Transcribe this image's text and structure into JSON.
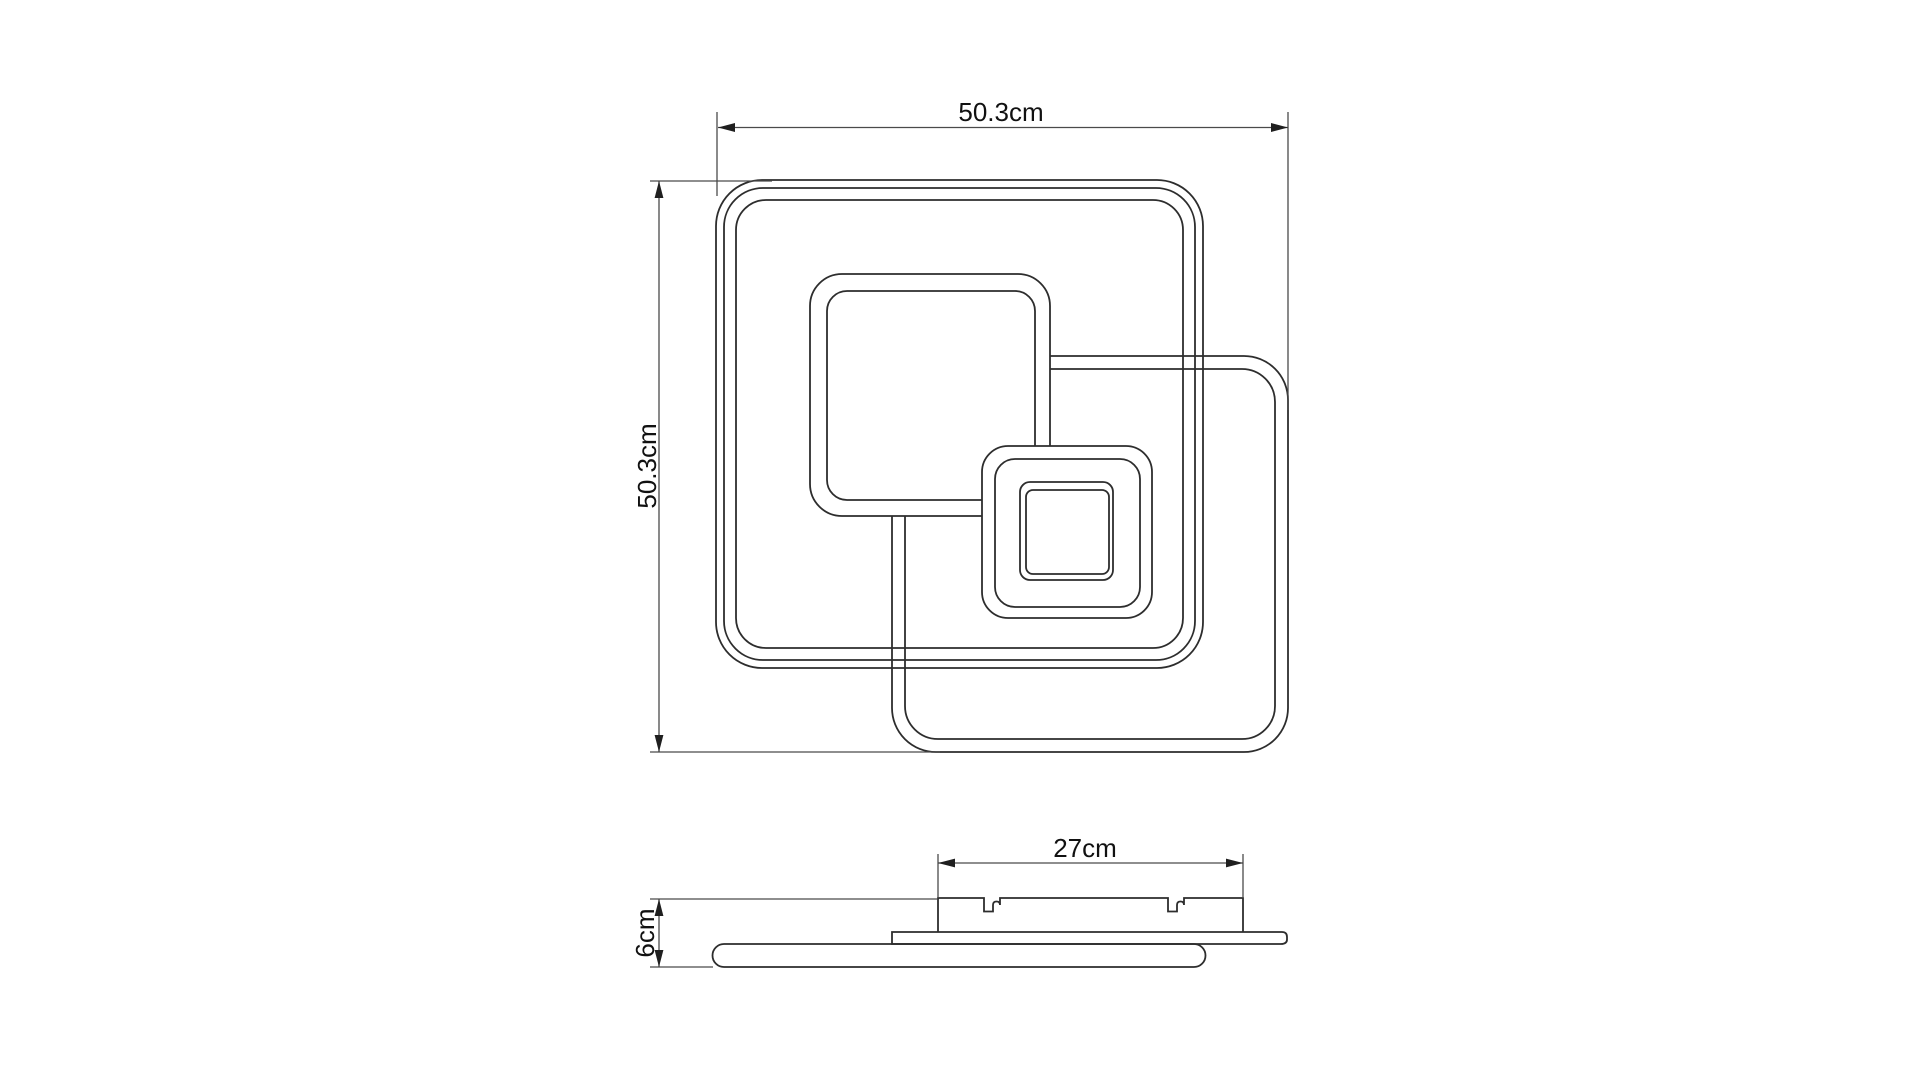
{
  "drawing": {
    "kind": "ceiling-lamp dimensional line drawing",
    "views": {
      "top_view": {
        "width_label": "50.3cm",
        "height_label": "50.3cm"
      },
      "side_view": {
        "width_label": "27cm",
        "height_label": "6cm"
      }
    },
    "colors": {
      "background": "#ffffff",
      "shape_line": "#2d2d2d",
      "dimension_line": "#4a4a4a",
      "text": "#111111"
    }
  }
}
